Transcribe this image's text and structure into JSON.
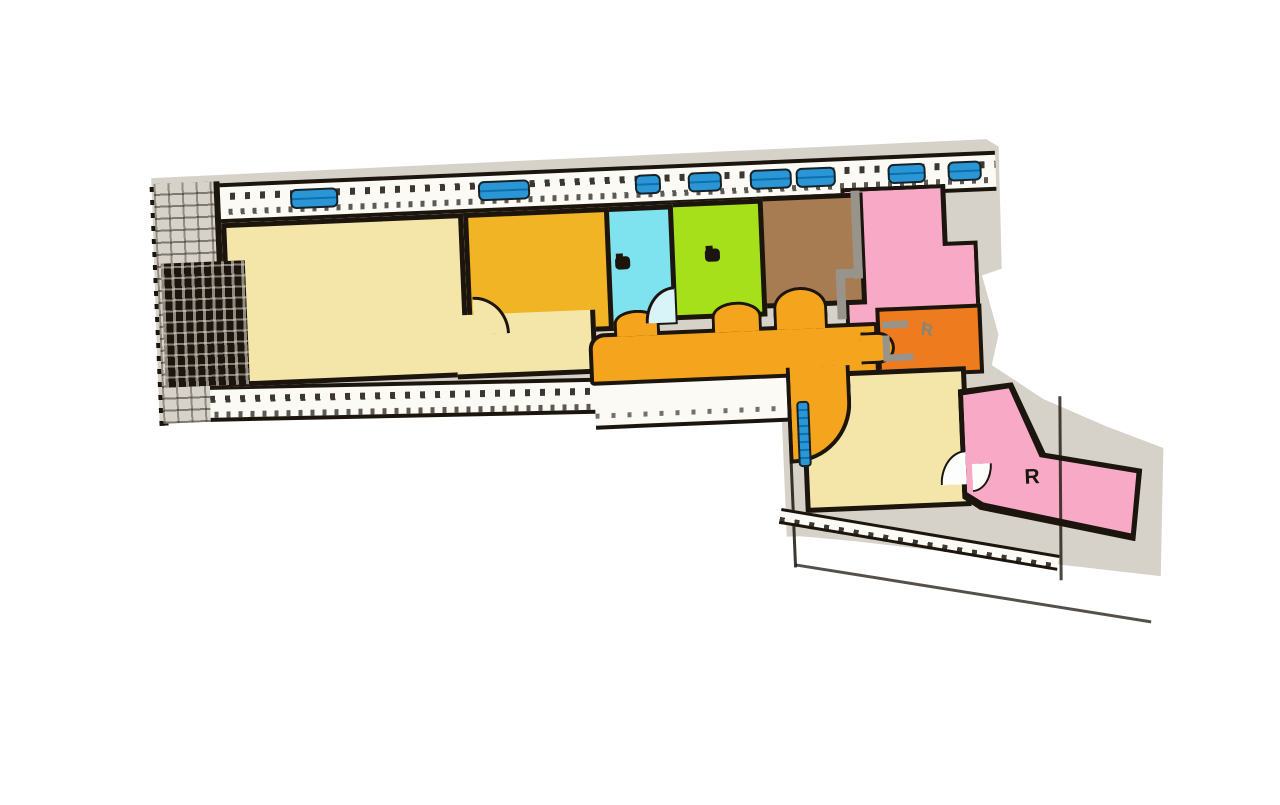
{
  "colors": {
    "page": "#ffffff",
    "paper": "#d7d2c9",
    "ink": "#1c150e",
    "band": "#fbfaf5",
    "cream": "#f4e6a8",
    "amber": "#f0b425",
    "cyan": "#7fe2ef",
    "green": "#a6e01b",
    "brown": "#a87c52",
    "pink": "#f7a9c6",
    "corr": "#f4a51d",
    "orange-r1": "#ee7b1d",
    "window": "#2a96d5",
    "grayline": "#98948c"
  },
  "labels": {
    "room_r": "R",
    "room_r1_main": "R",
    "room_r1_sub": "1"
  },
  "rooms": [
    {
      "name": "room-cream-large",
      "color_ref": "cream",
      "label": ""
    },
    {
      "name": "room-amber",
      "color_ref": "amber",
      "label": ""
    },
    {
      "name": "room-cyan",
      "color_ref": "cyan",
      "label": ""
    },
    {
      "name": "room-green",
      "color_ref": "green",
      "label": ""
    },
    {
      "name": "room-brown",
      "color_ref": "brown",
      "label": ""
    },
    {
      "name": "room-pink-upper",
      "color_ref": "pink",
      "label": ""
    },
    {
      "name": "room-orange-r1",
      "color_ref": "orange-r1",
      "label": "R1"
    },
    {
      "name": "corridor",
      "color_ref": "corr",
      "label": ""
    },
    {
      "name": "room-cream-lower",
      "color_ref": "cream",
      "label": ""
    },
    {
      "name": "room-pink-lower",
      "color_ref": "pink",
      "label": "R"
    }
  ]
}
